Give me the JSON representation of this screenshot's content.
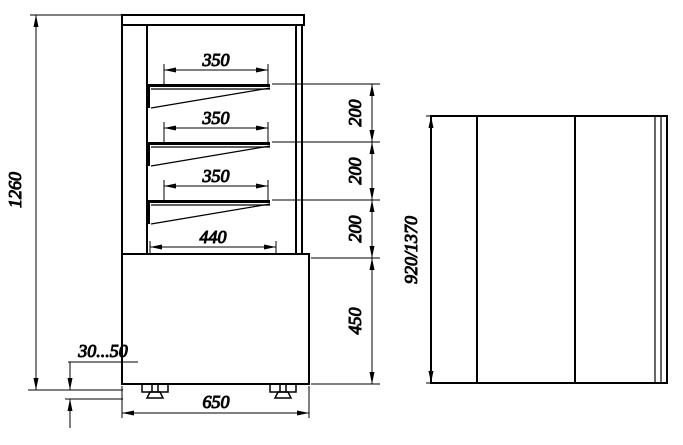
{
  "colors": {
    "line": "#000000",
    "background": "#ffffff"
  },
  "front_view": {
    "label": "front section view of display case",
    "dim_total_height": "1260",
    "dim_shelf_width_1": "350",
    "dim_shelf_width_2": "350",
    "dim_shelf_width_3": "350",
    "dim_bottom_shelf_width": "440",
    "dim_shelf_gap_1": "200",
    "dim_shelf_gap_2": "200",
    "dim_shelf_gap_3": "200",
    "dim_base_height": "450",
    "dim_base_width": "650",
    "dim_feet_adjust_range": "30...50"
  },
  "side_view": {
    "label": "side view of display case",
    "dim_height": "920/1370"
  }
}
